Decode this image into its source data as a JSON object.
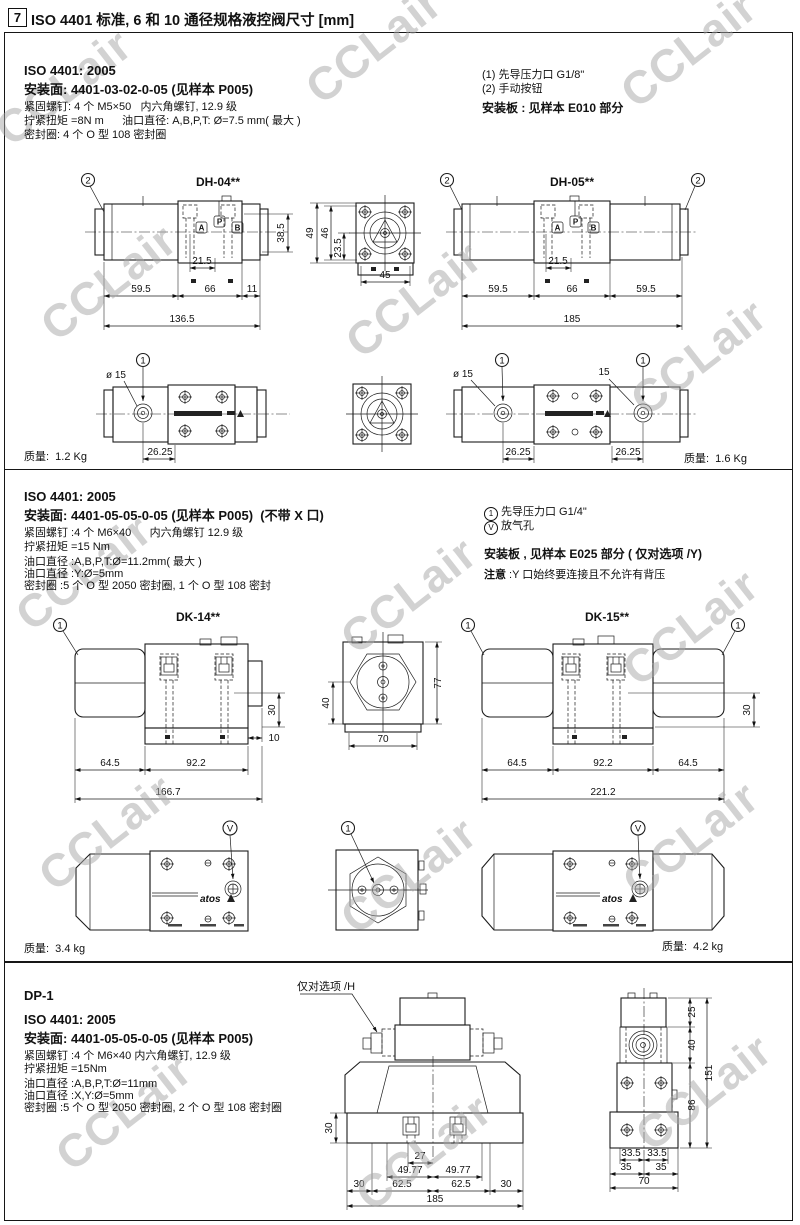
{
  "header": {
    "num": "7",
    "title": "ISO 4401 标准, 6 和 10 通径规格液控阀尺寸 [mm]"
  },
  "watermark": "CCLair",
  "s1": {
    "iso": "ISO 4401: 2005",
    "mount": "安装面: 4401-03-02-0-05 (见样本 P005)",
    "spec1": "紧固螺钉: 4 个 M5×50   内六角螺钉, 12.9 级",
    "spec2": "拧紧扭矩 =8N m      油口直径: A,B,P,T: Ø=7.5 mm( 最大 )",
    "spec3": "密封圈: 4 个 O 型 108 密封圈",
    "note1": "(1) 先导压力口 G1/8\"",
    "note2": "(2) 手动按钮",
    "note3": "安装板 : 见样本 E010 部分",
    "dh04": {
      "title": "DH-04**",
      "callout": "2",
      "portA": "A",
      "portP": "P",
      "portB": "B",
      "d_215": "21.5",
      "d_385": "38.5",
      "d_595": "59.5",
      "d_66": "66",
      "d_11": "11",
      "d_1365": "136.5"
    },
    "flange": {
      "d_49": "49",
      "d_46": "46",
      "d_235": "23.5",
      "d_45": "45"
    },
    "dh05": {
      "title": "DH-05**",
      "callout_l": "2",
      "callout_r": "2",
      "portA": "A",
      "portP": "P",
      "portB": "B",
      "d_215": "21.5",
      "d_595l": "59.5",
      "d_66": "66",
      "d_595r": "59.5",
      "d_185": "185"
    },
    "bot_left": {
      "callout": "1",
      "dia": "ø 15",
      "d_2625": "26.25",
      "weight": "质量:  1.2 Kg"
    },
    "bot_right": {
      "callout_l": "1",
      "callout_r": "1",
      "dia": "ø 15",
      "d_15": "15",
      "d_2625l": "26.25",
      "d_2625r": "26.25",
      "weight": "质量:  1.6 Kg"
    }
  },
  "s2": {
    "iso": "ISO 4401: 2005",
    "mount": "安装面: 4401-05-05-0-05 (见样本 P005)  (不带 X 口)",
    "spec1": "紧固螺钉 :4 个 M6×40      内六角螺钉 12.9 级",
    "spec2": "拧紧扭矩 =15 Nm",
    "spec3": "油口直径 :A,B,P,T:Ø=11.2mm( 最大 )",
    "spec4": "油口直径 :Y:Ø=5mm",
    "spec5": "密封圈 :5 个 O 型 2050 密封圈, 1 个 O 型 108 密封",
    "note1_sym": "1",
    "note1": "先导压力口 G1/4\"",
    "note2_sym": "V",
    "note2": "放气孔",
    "note3": "安装板 , 见样本 E025 部分 ( 仅对选项 /Y)",
    "note4_label": "注意",
    "note4": " :Y 口始终要连接且不允许有背压",
    "dk14": {
      "title": "DK-14**",
      "callout": "1",
      "d_30": "30",
      "d_10": "10",
      "d_645": "64.5",
      "d_922": "92.2",
      "d_1667": "166.7"
    },
    "flange": {
      "d_40": "40",
      "d_77": "77",
      "d_70": "70"
    },
    "dk15": {
      "title": "DK-15**",
      "callout_l": "1",
      "callout_r": "1",
      "d_30": "30",
      "d_645l": "64.5",
      "d_922": "92.2",
      "d_645r": "64.5",
      "d_2212": "221.2"
    },
    "bot_left": {
      "callout": "V",
      "logo": "atos",
      "weight": "质量:  3.4 kg"
    },
    "bot_mid": {
      "callout": "1"
    },
    "bot_right": {
      "callout": "V",
      "logo": "atos",
      "weight": "质量:  4.2 kg"
    }
  },
  "s3": {
    "model": "DP-1",
    "iso": "ISO 4401: 2005",
    "mount": "安装面: 4401-05-05-0-05 (见样本 P005)",
    "spec1": "紧固螺钉 :4 个 M6×40 内六角螺钉, 12.9 级",
    "spec2": "拧紧扭矩 =15Nm",
    "spec3": "油口直径 :A,B,P,T:Ø=11mm",
    "spec4": "油口直径 :X,Y:Ø=5mm",
    "spec5": "密封圈 :5 个 O 型 2050 密封圈, 2 个 O 型 108 密封圈",
    "option_h": "仅对选项 /H",
    "front": {
      "d_30": "30",
      "d_27": "27",
      "d_4977l": "49.77",
      "d_4977r": "49.77",
      "d_30l": "30",
      "d_625l": "62.5",
      "d_625r": "62.5",
      "d_30r": "30",
      "d_185": "185"
    },
    "side": {
      "d_25": "25",
      "d_40": "40",
      "d_151": "151",
      "d_86": "86",
      "d_335l": "33.5",
      "d_335r": "33.5",
      "d_35l": "35",
      "d_35r": "35",
      "d_70": "70"
    }
  }
}
